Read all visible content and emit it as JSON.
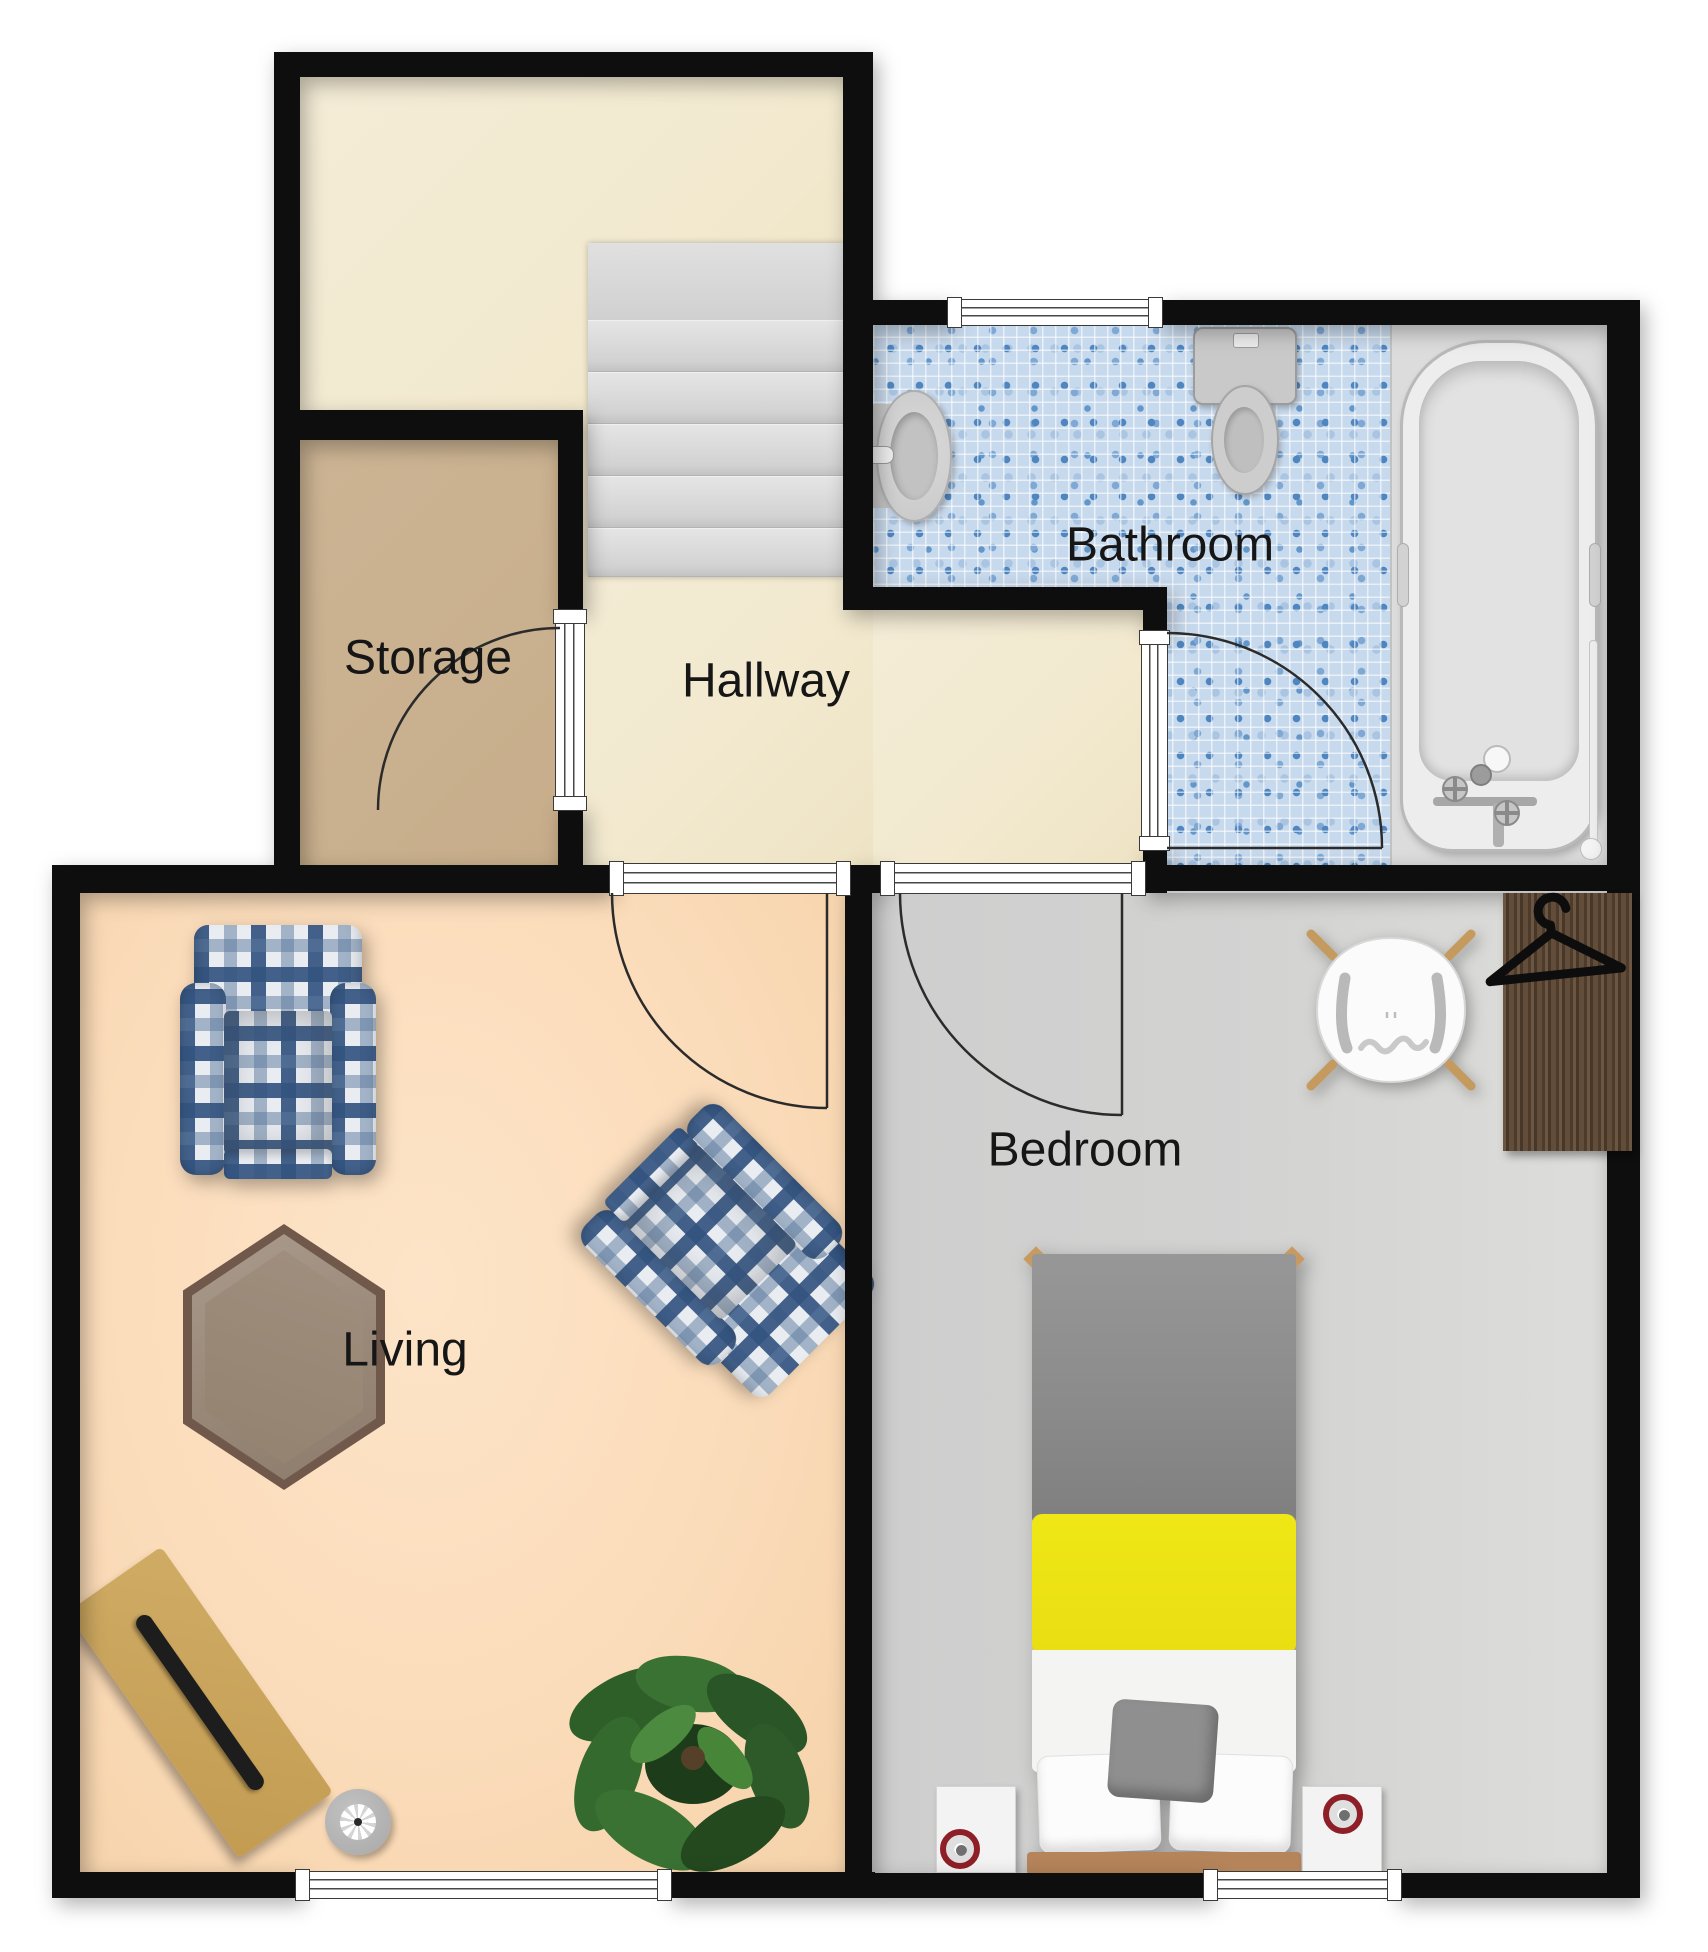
{
  "plan": {
    "type": "apartment-floor-plan",
    "rooms": [
      {
        "id": "storage",
        "label": "Storage"
      },
      {
        "id": "hallway",
        "label": "Hallway"
      },
      {
        "id": "bathroom",
        "label": "Bathroom"
      },
      {
        "id": "living",
        "label": "Living"
      },
      {
        "id": "bedroom",
        "label": "Bedroom"
      },
      {
        "id": "landing",
        "label": ""
      }
    ],
    "furniture": [
      "staircase",
      "storage-door",
      "bathroom-door",
      "living-door",
      "bedroom-door",
      "bathroom-window",
      "living-window",
      "bedroom-window",
      "bathroom-sink",
      "toilet",
      "bathtub",
      "shower-rail",
      "wardrobe",
      "clothes-hanger-icon",
      "desk-chair",
      "double-bed",
      "nightstand",
      "alarm-clock",
      "plaid-armchair",
      "hexagonal-coffee-table",
      "writing-desk",
      "laptop",
      "floor-speaker",
      "potted-plant"
    ],
    "colors": {
      "wall": "#0e0e0e",
      "landing_floor": "#f2e9cf",
      "hallway_floor": "#f2e9cf",
      "storage_floor": "#c9b08e",
      "living_floor": "#fbdcbc",
      "bedroom_floor": "#d2d2d0",
      "bathroom_tile_base": "#c7d9ec",
      "bathroom_tile_accent": "#4f86c0",
      "tub_platform": "#dcdcdc",
      "stairs": "#d8d8d8",
      "wardrobe_wood": "#5a432f",
      "bed_duvet": "#8f8f8f",
      "bed_runner": "#ece31b",
      "bed_sheet": "#f4f4f2",
      "bed_frame_wood": "#b5845a",
      "plaid_navy": "#34547f",
      "plaid_pale": "#e8ecf1",
      "table_wood": "#9b8a7d",
      "desk_wood": "#c9a45c",
      "clock_ring": "#8e1f26",
      "plant_green": "#2f5f29",
      "fixture_gray": "#cccccc"
    }
  }
}
